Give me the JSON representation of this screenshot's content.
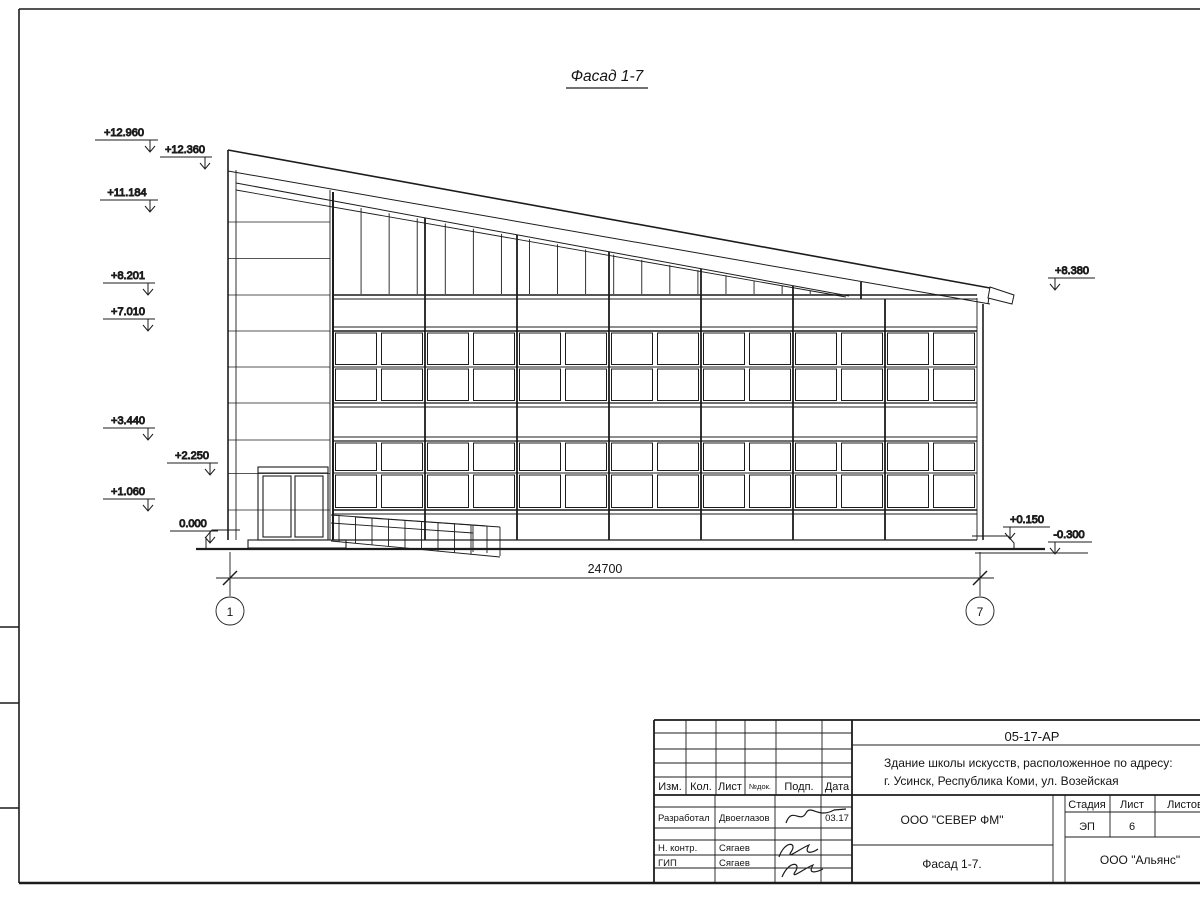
{
  "colors": {
    "ink": "#1c1c1c",
    "paper": "#ffffff"
  },
  "drawing": {
    "title": "Фасад 1-7",
    "dimension_total": "24700",
    "axes": {
      "left": "1",
      "right": "7"
    },
    "elevation_marks_left": [
      "+12.960",
      "+12.360",
      "+11.184",
      "+8.201",
      "+7.010",
      "+3.440",
      "+2.250",
      "+1.060",
      "0.000"
    ],
    "elevation_marks_right": [
      "+8.380",
      "+0.150",
      "-0.300"
    ]
  },
  "title_block": {
    "doc_number": "05-17-АР",
    "project_line1": "Здание школы искусств, расположенное по адресу:",
    "project_line2": "г. Усинск, Республика Коми, ул. Возейская",
    "rev_headers": [
      "Изм.",
      "Кол.",
      "Лист",
      "№док.",
      "Подп.",
      "Дата"
    ],
    "signature_rows": [
      {
        "role": "Разработал",
        "name": "Двоеглазов",
        "date": "03.17"
      },
      {
        "role": "Н. контр.",
        "name": "Сягаев",
        "date": ""
      },
      {
        "role": "ГИП",
        "name": "Сягаев",
        "date": ""
      }
    ],
    "company": "ООО \"СЕВЕР ФМ\"",
    "stage_label": "Стадия",
    "sheet_label": "Лист",
    "sheets_label": "Листов",
    "stage_value": "ЭП",
    "sheet_value": "6",
    "drawing_title": "Фасад 1-7.",
    "org": "ООО \"Альянс\""
  }
}
